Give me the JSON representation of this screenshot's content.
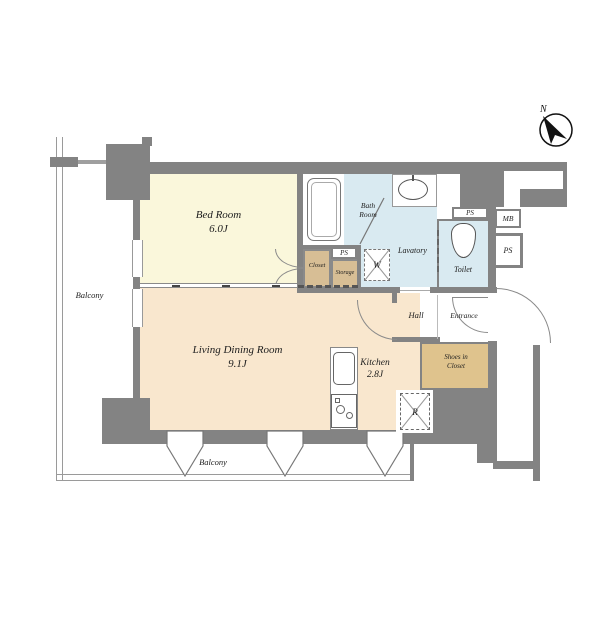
{
  "plan": {
    "compass": {
      "north": "N"
    },
    "balcony": {
      "left": "Balcony",
      "bottom": "Balcony"
    },
    "rooms": {
      "bedroom": {
        "name": "Bed Room",
        "size": "6.0J"
      },
      "living": {
        "name": "Living Dining Room",
        "size": "9.1J"
      },
      "kitchen": {
        "name": "Kitchen",
        "size": "2.8J"
      },
      "bath": {
        "name_line1": "Bath",
        "name_line2": "Room"
      },
      "lavatory": {
        "name": "Lavatory"
      },
      "toilet": {
        "name": "Toilet"
      },
      "hall": {
        "name": "Hall"
      },
      "entrance": {
        "name": "Entrance"
      },
      "shoes_closet": {
        "name_line1": "Shoes in",
        "name_line2": "Closet"
      },
      "closet": {
        "name": "Closet"
      },
      "storage": {
        "name": "Storage"
      }
    },
    "shafts": {
      "mb": "MB",
      "ps_shaft_right": "PS",
      "ps_shaft_toilet": "PS",
      "ps_shaft_storage": "PS"
    },
    "appliances": {
      "washer": "W",
      "refrigerator": "R"
    },
    "colors": {
      "wall": "#838383",
      "bedroom_floor": "#FAF7DB",
      "living_floor": "#F9E7CE",
      "wet_area_floor": "#D9EAF1",
      "closet_floor": "#D7BE95",
      "shoes_closet_floor": "#DFC38D"
    }
  }
}
